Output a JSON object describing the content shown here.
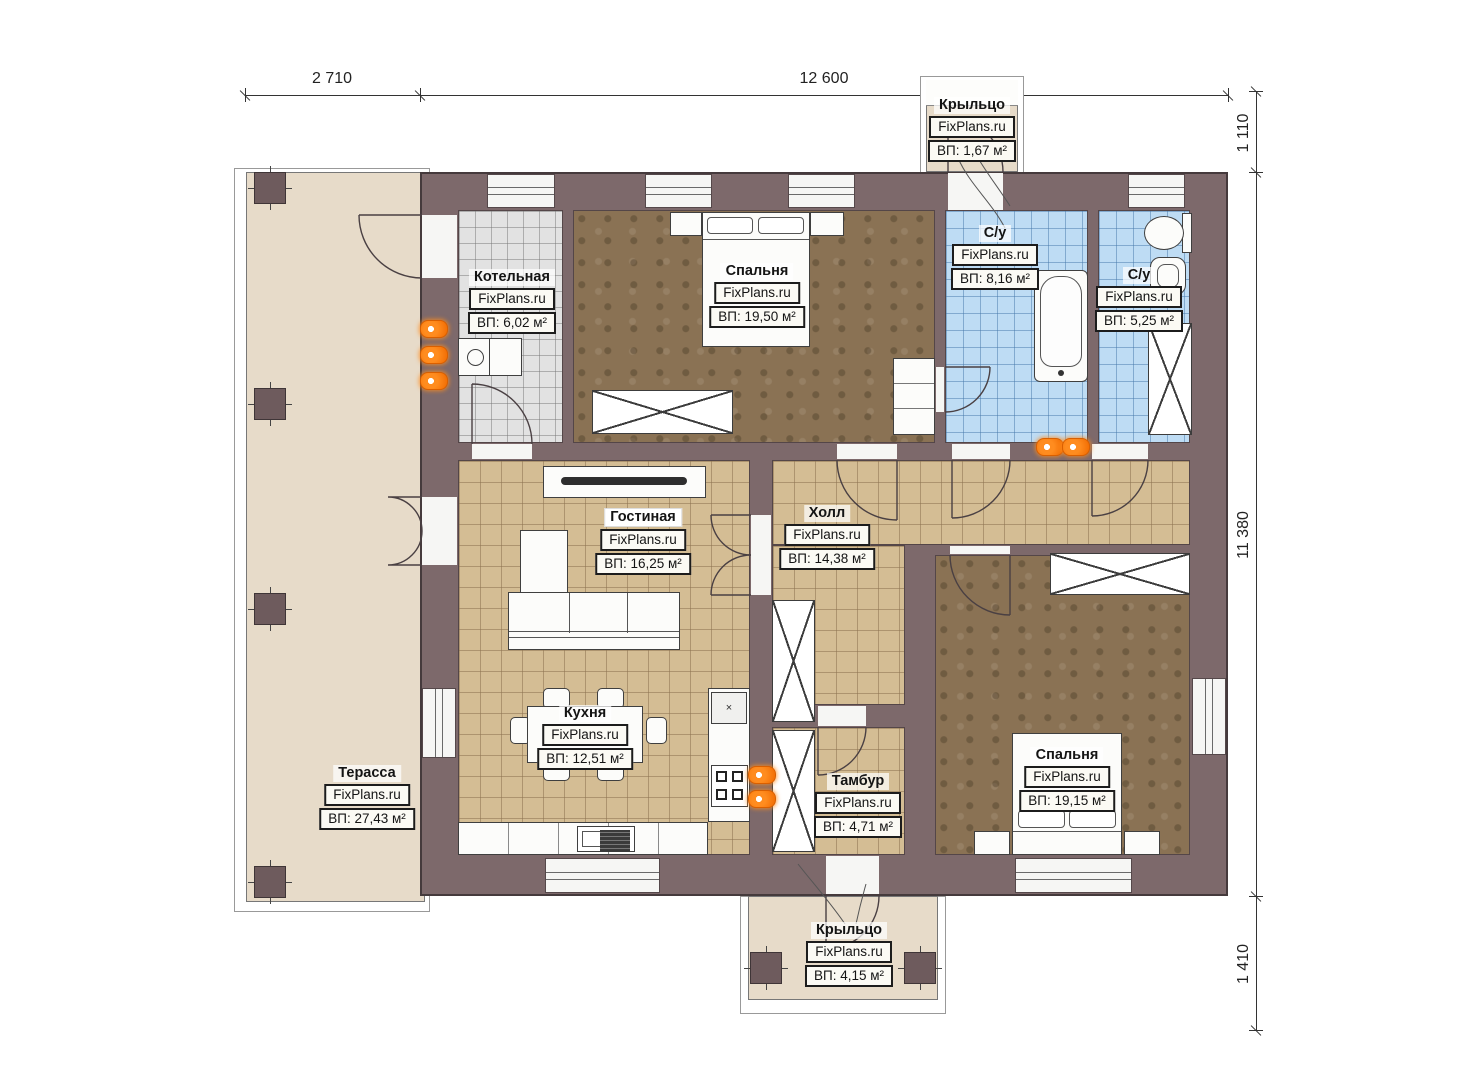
{
  "watermark": "FixPlans.ru",
  "dims": {
    "top_left": "2 710",
    "top_right": "12 600",
    "right_top": "1 110",
    "right_mid": "11 380",
    "right_bottom": "1 410"
  },
  "rooms": {
    "boiler": {
      "name": "Котельная",
      "wm": "FixPlans.ru",
      "area": "ВП: 6,02 м²"
    },
    "bedroom1": {
      "name": "Спальня",
      "wm": "FixPlans.ru",
      "area": "ВП: 19,50 м²"
    },
    "bath1": {
      "name": "С/у",
      "wm": "FixPlans.ru",
      "area": "ВП: 8,16 м²"
    },
    "bath2": {
      "name": "С/у",
      "wm": "FixPlans.ru",
      "area": "ВП: 5,25 м²"
    },
    "living": {
      "name": "Гостиная",
      "wm": "FixPlans.ru",
      "area": "ВП: 16,25 м²"
    },
    "hall": {
      "name": "Холл",
      "wm": "FixPlans.ru",
      "area": "ВП: 14,38 м²"
    },
    "kitchen": {
      "name": "Кухня",
      "wm": "FixPlans.ru",
      "area": "ВП: 12,51 м²"
    },
    "vestibule": {
      "name": "Тамбур",
      "wm": "FixPlans.ru",
      "area": "ВП: 4,71 м²"
    },
    "bedroom2": {
      "name": "Спальня",
      "wm": "FixPlans.ru",
      "area": "ВП: 19,15 м²"
    },
    "terrace": {
      "name": "Терасса",
      "wm": "FixPlans.ru",
      "area": "ВП: 27,43 м²"
    },
    "porch_top": {
      "name": "Крыльцо",
      "wm": "FixPlans.ru",
      "area": "ВП: 1,67 м²"
    },
    "porch_bottom": {
      "name": "Крыльцо",
      "wm": "FixPlans.ru",
      "area": "ВП: 4,15 м²"
    }
  },
  "colors": {
    "wall": "#7d696b",
    "terrace": "#e7dbc9",
    "tile_tan": "#d4bd94",
    "tile_blue": "#bedcf4",
    "tile_gray": "#e2e2e2",
    "floor_brown": "#8a7254",
    "radiator": "#ff8c1f"
  }
}
